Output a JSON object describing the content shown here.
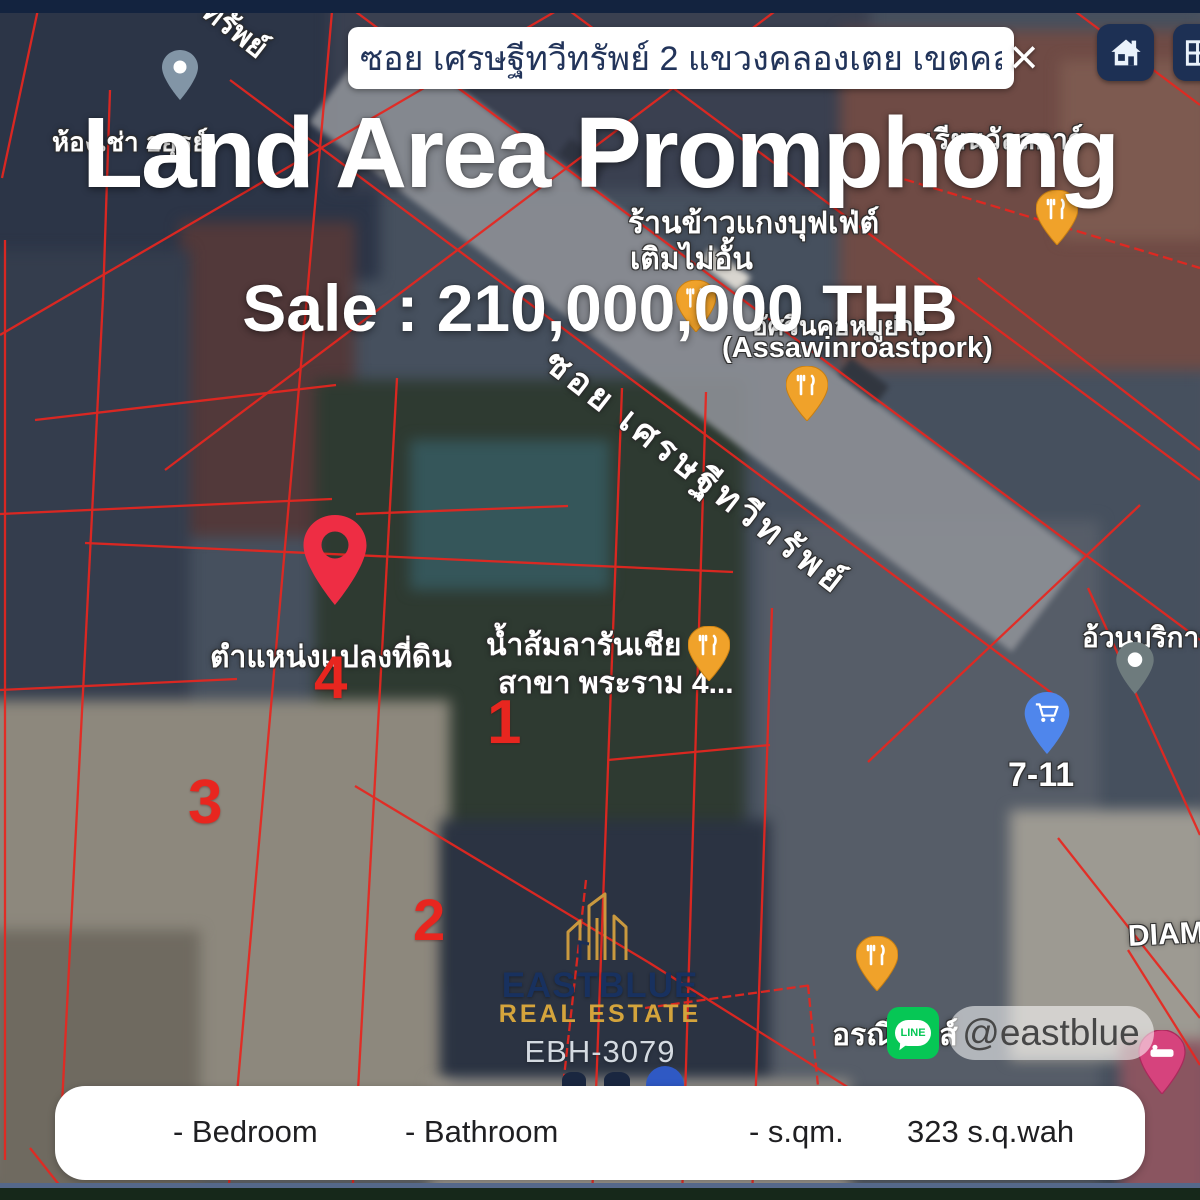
{
  "top_bar": {
    "search_value": "ซอย เศรษฐีทวีทรัพย์ 2 แขวงคลองเตย เขตคลองเตย",
    "close_glyph": "×"
  },
  "overlay": {
    "title": "Land Area Promphong",
    "price": "Sale : 210,000,000 THB"
  },
  "map_labels": {
    "rental": "ห้องเช่า อยุธย์",
    "road_partial": "ทรัพย์",
    "school": "เรียนวัลลการ์",
    "buffet_line1": "ร้านข้าวแกงบุฟเฟ่ต์",
    "buffet_line2": "เติมไม่อั้น",
    "roastpork_thai": "อัศวินคอหมูย่าง",
    "roastpork_en": "(Assawinroastpork)",
    "road": "ซอย เศรษฐีทวีทรัพย์",
    "plot_location": "ตำแหน่งแปลงที่ดิน",
    "juice_line1": "น้ำส้มลารันเชีย",
    "juice_line2": "สาขา พระราม 4...",
    "service": "อ้วนบริการ",
    "seven_eleven": "7-11",
    "oranee": "อรณีเฮ้าส์",
    "diamond": "DIAM",
    "plot_numbers": [
      "1",
      "2",
      "3",
      "4"
    ]
  },
  "branding": {
    "company": "EASTBLUE",
    "tagline": "REAL ESTATE",
    "listing_id": "EBH-3079",
    "line_handle": "@eastblue",
    "line_label": "LINE"
  },
  "details_bar": {
    "bedroom": "- Bedroom",
    "bathroom": "- Bathroom",
    "area_sqm": "- s.qm.",
    "area_wah": "323  s.q.wah"
  },
  "colors": {
    "accent_red": "#e8261f",
    "navy": "#1d3054",
    "gold": "#d4a43c",
    "line_green": "#06c755",
    "pin_yellow": "#f0a22a",
    "pin_blue": "#4f86ec",
    "pin_red": "#ee2d44",
    "pin_pink": "#d6437d"
  }
}
